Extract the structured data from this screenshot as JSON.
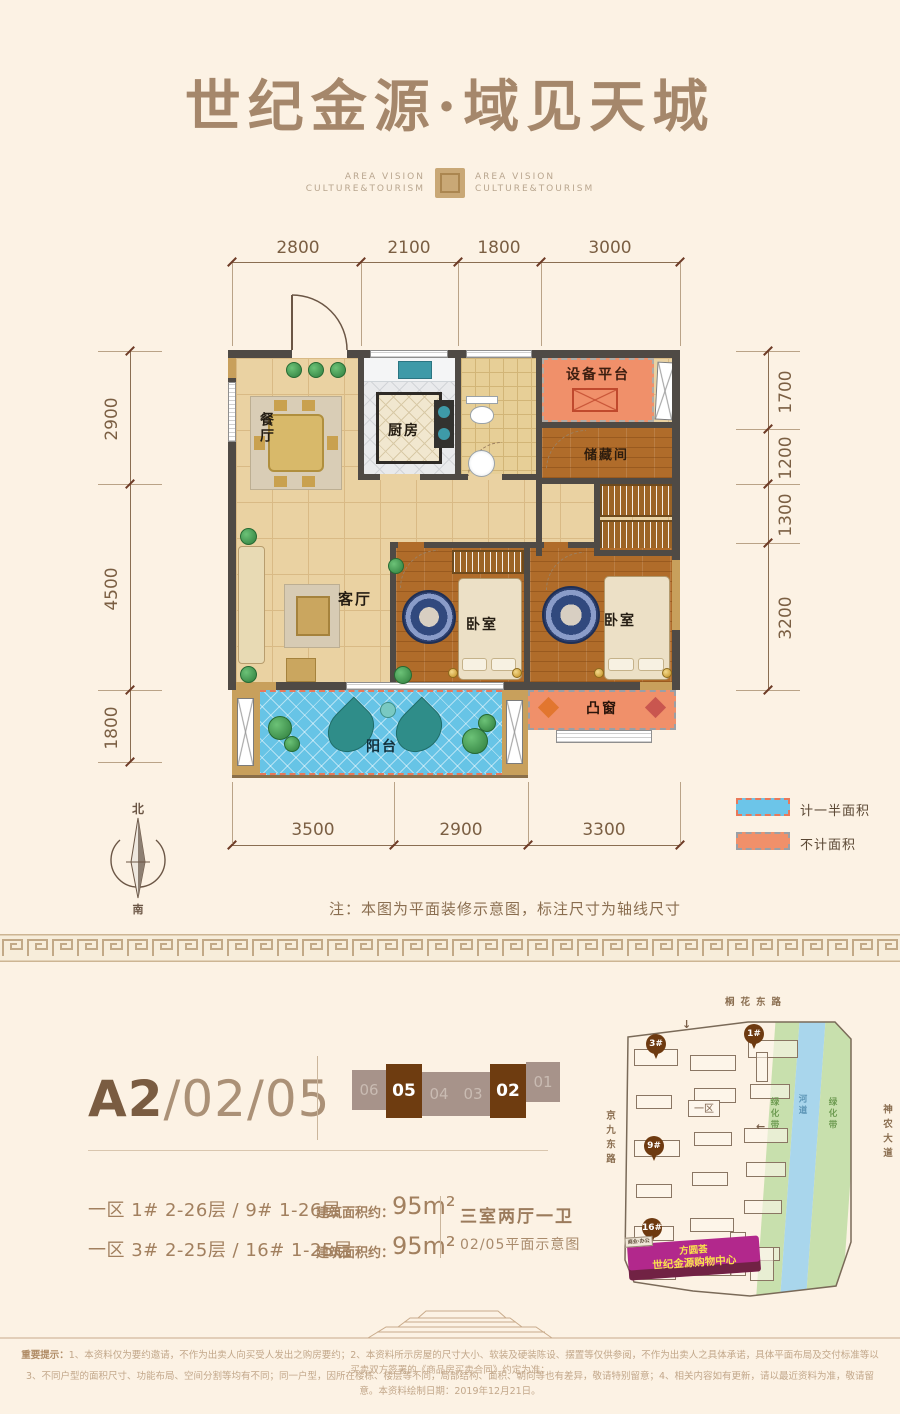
{
  "header": {
    "title": "世纪金源·域见天城",
    "logo_left_line1": "AREA VISION",
    "logo_left_line2": "CULTURE&TOURISM",
    "logo_right_line1": "AREA VISION",
    "logo_right_line2": "CULTURE&TOURISM"
  },
  "floorplan": {
    "dims_top": [
      "2800",
      "2100",
      "1800",
      "3000"
    ],
    "dims_left": [
      "2900",
      "4500",
      "1800"
    ],
    "dims_right": [
      "1700",
      "1200",
      "1300",
      "3200"
    ],
    "dims_bottom": [
      "3500",
      "2900",
      "3300"
    ],
    "rooms": {
      "dining": "餐厅",
      "kitchen": "厨房",
      "equipment": "设备平台",
      "storage": "储藏间",
      "living": "客厅",
      "bedroom1": "卧室",
      "bedroom2": "卧室",
      "bay_window": "凸窗",
      "balcony": "阳台"
    },
    "compass": {
      "north": "北",
      "south": "南"
    },
    "legend": [
      {
        "label": "计一半面积",
        "color": "#6cc5e9"
      },
      {
        "label": "不计面积",
        "color": "#f0906a"
      }
    ],
    "note": "注：本图为平面装修示意图，标注尺寸为轴线尺寸"
  },
  "unit": {
    "code_bold": "A2",
    "code_rest": "/02/05",
    "strip": [
      {
        "num": "06",
        "active": false
      },
      {
        "num": "05",
        "active": true
      },
      {
        "num": "04",
        "active": false
      },
      {
        "num": "03",
        "active": false
      },
      {
        "num": "02",
        "active": true
      },
      {
        "num": "01",
        "active": false
      }
    ],
    "rows": [
      {
        "floors": "一区 1# 2-26层 / 9# 1-26层",
        "area_label": "建筑面积约：",
        "area": "95m²"
      },
      {
        "floors": "一区 3# 2-25层 / 16# 1-25层",
        "area_label": "建筑面积约：",
        "area": "95m²"
      }
    ],
    "type": "三室两厅一卫",
    "type_note": "02/05平面示意图"
  },
  "sitemap": {
    "road_top": "桐花东路",
    "road_left": "京九东路",
    "road_right": "神农大道",
    "zone_label": "一区",
    "green_label": "绿化带",
    "river_label": "河道",
    "green_label2": "绿化带",
    "markers": [
      "3#",
      "1#",
      "9#",
      "16#"
    ],
    "mall_tag": "商业·办公",
    "mall_name1": "方圆荟",
    "mall_name2": "世纪金源购物中心"
  },
  "footer": {
    "prefix": "重要提示：",
    "line1": "1、本资料仅为要约邀请，不作为出卖人向买受人发出之购房要约；2、本资料所示房屋的尺寸大小、软装及硬装陈设、摆置等仅供参阅，不作为出卖人之具体承诺，具体平面布局及交付标准等以买卖双方签署的《商品房买卖合同》约定为准；",
    "line2": "3、不同户型的面积尺寸、功能布局、空间分割等均有不同；同一户型，因所在楼栋、楼层等不同，局部结构、面积、朝向等也有差异，敬请特别留意；4、相关内容如有更新，请以最近资料为准，敬请留意。本资料绘制日期：2019年12月21日。"
  }
}
